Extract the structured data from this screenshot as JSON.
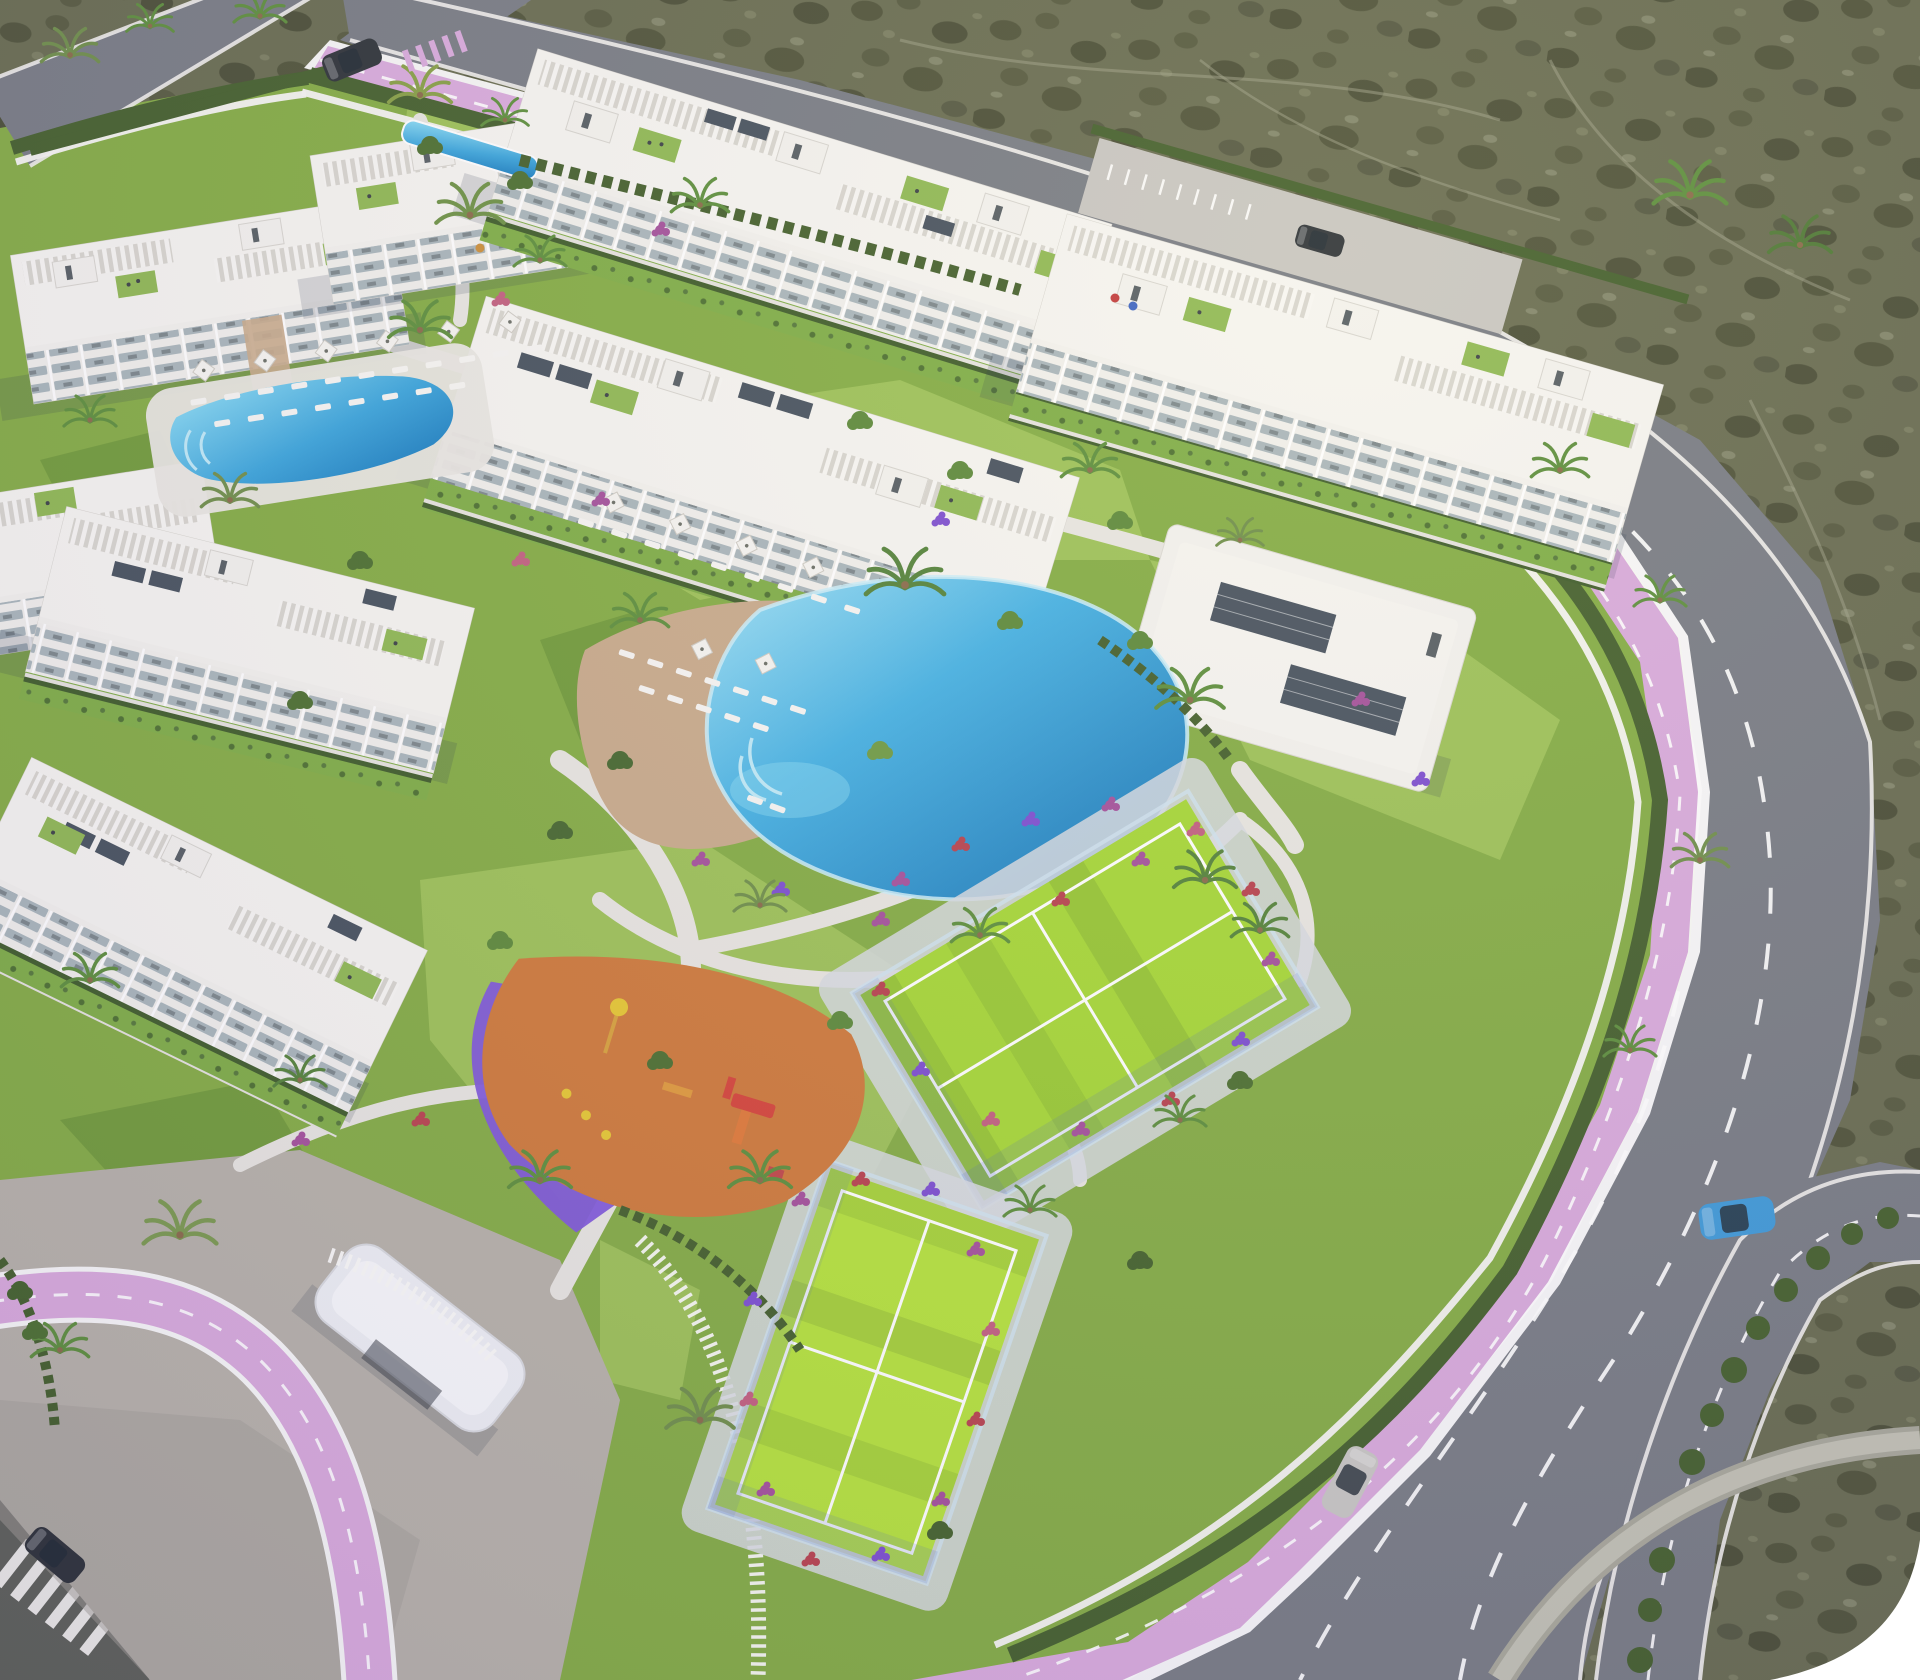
{
  "meta": {
    "title": "Aerial 3D architectural rendering of a Mediterranean residential resort complex",
    "view": "aerial oblique bird's-eye",
    "setting": "coastal scrubland surrounds the walled parcel on the top and right"
  },
  "colors": {
    "grass": "#84ad44",
    "grassLight": "#9dc257",
    "grassDark": "#6d9738",
    "scrub": "#686c50",
    "scrubDark": "#4f5339",
    "asphalt": "#787c84",
    "asphaltDark": "#5e6158",
    "pavement": "#b7b2a9",
    "sidewalk": "#e3e1dc",
    "bikeLane": "#d9abdc",
    "poolBlue": "#2e9fd8",
    "poolLight": "#8adcf5",
    "poolDeep": "#1679bd",
    "sand": "#c9ab8b",
    "building": "#f3f2ee",
    "buildingShade": "#d9d7d2",
    "glass": "#a9b6bb",
    "solar": "#47525e",
    "courtGreen": "#a6d836",
    "courtGreenBright": "#b5e33c",
    "playOrange": "#cf7a3a",
    "playPurple": "#8059da",
    "hedge": "#44602c",
    "palm": "#5d8f3c",
    "flowerMagenta": "#a4519b",
    "flowerRed": "#b8434e",
    "flowerPurple": "#7d4fd0",
    "flowerPink": "#c2607f",
    "carBlue": "#3f9ad8",
    "carSilver": "#c8c7c3",
    "carDark": "#2e3338",
    "shadow": "#233049"
  },
  "scene": {
    "buildings": [
      {
        "id": "block-a1",
        "kind": "apartment block",
        "floors": 4,
        "features": [
          "roof pergolas",
          "terraces",
          "balconies"
        ]
      },
      {
        "id": "block-a2",
        "kind": "apartment block",
        "floors": 4,
        "features": [
          "roof pergolas",
          "terraces"
        ]
      },
      {
        "id": "block-b",
        "kind": "apartment block",
        "floors": 4,
        "features": [
          "roof pergolas",
          "solar panels",
          "balconies"
        ]
      },
      {
        "id": "block-c",
        "kind": "apartment block",
        "floors": 4,
        "features": [
          "solar panels",
          "roof gardens",
          "private hedged gardens"
        ]
      },
      {
        "id": "block-d",
        "kind": "apartment block",
        "floors": 4,
        "features": [
          "balconies"
        ]
      },
      {
        "id": "block-e1",
        "kind": "apartment block",
        "floors": 4,
        "features": [
          "stepped roof terraces"
        ]
      },
      {
        "id": "block-e2",
        "kind": "apartment block",
        "floors": 4,
        "features": [
          "stepped roof terraces",
          "solar panels"
        ]
      },
      {
        "id": "block-f",
        "kind": "apartment block",
        "floors": 4,
        "features": [
          "roof pergolas",
          "parking forecourt",
          "bike racks"
        ]
      },
      {
        "id": "clubhouse",
        "kind": "amenity pavilion",
        "floors": 1,
        "features": [
          "two rooftop solar arrays"
        ]
      }
    ],
    "pools": [
      {
        "id": "upper-pool",
        "kind": "community pool",
        "deck": "white",
        "loungers": true,
        "parasols": true
      },
      {
        "id": "central-lagoon",
        "kind": "lagoon-style pool",
        "deck": "sand-colored beach deck",
        "loungers": true
      }
    ],
    "sports": [
      {
        "id": "court-north",
        "kind": "padel/tennis court",
        "surface": "bright green",
        "fence": "glass"
      },
      {
        "id": "court-south",
        "kind": "padel/tennis court",
        "surface": "bright green",
        "fence": "glass"
      }
    ],
    "playground": {
      "surface": [
        "orange",
        "purple"
      ],
      "equipment": [
        "slide",
        "climber",
        "spring riders",
        "flag pole"
      ]
    },
    "roads": [
      {
        "id": "top-road",
        "kind": "asphalt road",
        "markings": "white edge lines"
      },
      {
        "id": "avenue",
        "kind": "main avenue",
        "markings": "dashed white lanes",
        "bikeLane": "pink, dashed"
      },
      {
        "id": "outer-carriageway",
        "kind": "dual carriageway with hedge median"
      },
      {
        "id": "bottom-left-road",
        "kind": "dark road with zebra crosswalk"
      }
    ],
    "vehicles": [
      {
        "id": "car-blue",
        "color": "blue",
        "location": "outer carriageway bend"
      },
      {
        "id": "car-silver",
        "color": "silver",
        "location": "avenue, lower section"
      },
      {
        "id": "car-dark-1",
        "color": "dark",
        "location": "top road"
      },
      {
        "id": "car-dark-2",
        "color": "dark",
        "location": "parking forecourt"
      },
      {
        "id": "car-dark-3",
        "color": "dark",
        "location": "bottom-left road"
      }
    ],
    "landscape": [
      "palm trees",
      "cypress hedges",
      "flowering shrubs",
      "lawns",
      "perimeter white wall",
      "picket fence",
      "entrance canopy",
      "paved plaza",
      "scrubland with dirt trails"
    ]
  }
}
